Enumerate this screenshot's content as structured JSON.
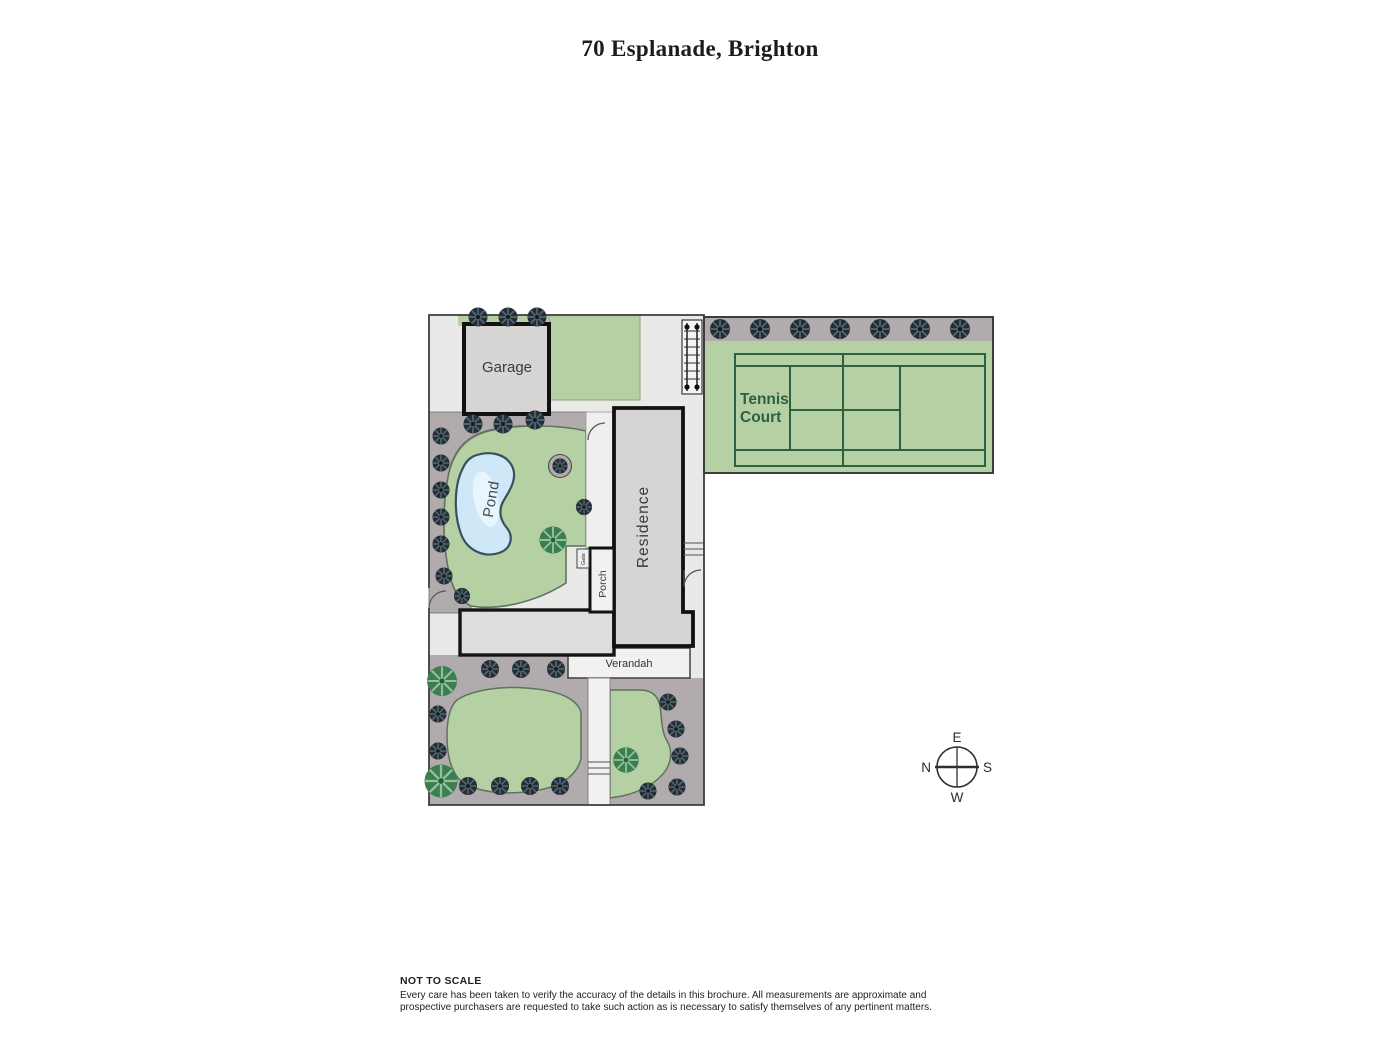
{
  "title": "70 Esplanade, Brighton",
  "labels": {
    "garage": "Garage",
    "pond": "Pond",
    "residence": "Residence",
    "porch": "Porch",
    "gate": "Gate",
    "verandah": "Verandah",
    "tennis_court_line1": "Tennis",
    "tennis_court_line2": "Court"
  },
  "compass": {
    "top": "E",
    "right": "S",
    "bottom": "W",
    "left": "N"
  },
  "footer": {
    "heading": "NOT TO SCALE",
    "line1": "Every care has been taken to verify the accuracy of the details in this brochure. All measurements are approximate and",
    "line2": "prospective purchasers are requested to take such action as is necessary to satisfy themselves of any pertinent matters."
  },
  "colors": {
    "site_base": "#e9e9e7",
    "lawn": "#b5d1a3",
    "planting_bed": "#b2abae",
    "building": "#d7d5d3",
    "pond_water": "#cfe8f7",
    "court_lines": "#2d5f43",
    "tree_dark": "#232e37",
    "tree_green": "#3e7c51",
    "boundary": "#3d3d3d"
  },
  "plan": {
    "trees": {
      "dark": [
        [
          478,
          317,
          1
        ],
        [
          508,
          317,
          1
        ],
        [
          537,
          317,
          1
        ],
        [
          720,
          329,
          1.05
        ],
        [
          760,
          329,
          1.05
        ],
        [
          800,
          329,
          1.05
        ],
        [
          840,
          329,
          1.05
        ],
        [
          880,
          329,
          1.05
        ],
        [
          920,
          329,
          1.05
        ],
        [
          960,
          329,
          1.05
        ],
        [
          473,
          424,
          1
        ],
        [
          503,
          424,
          1
        ],
        [
          535,
          420,
          1
        ],
        [
          441,
          436,
          0.9
        ],
        [
          441,
          463,
          0.9
        ],
        [
          441,
          490,
          0.9
        ],
        [
          441,
          517,
          0.9
        ],
        [
          441,
          544,
          0.9
        ],
        [
          444,
          576,
          0.9
        ],
        [
          462,
          596,
          0.85
        ],
        [
          560,
          466,
          0.8
        ],
        [
          584,
          507,
          0.85
        ],
        [
          490,
          669,
          0.95
        ],
        [
          521,
          669,
          0.95
        ],
        [
          556,
          669,
          0.95
        ],
        [
          438,
          714,
          0.9
        ],
        [
          438,
          751,
          0.9
        ],
        [
          468,
          786,
          0.95
        ],
        [
          500,
          786,
          0.95
        ],
        [
          530,
          786,
          0.95
        ],
        [
          560,
          786,
          0.95
        ],
        [
          668,
          702,
          0.9
        ],
        [
          676,
          729,
          0.9
        ],
        [
          680,
          756,
          0.9
        ],
        [
          677,
          787,
          0.9
        ],
        [
          648,
          791,
          0.9
        ]
      ],
      "green": [
        [
          442,
          681,
          1
        ],
        [
          441,
          781,
          1.1
        ],
        [
          626,
          760,
          0.85
        ],
        [
          553,
          540,
          0.9
        ]
      ]
    }
  }
}
